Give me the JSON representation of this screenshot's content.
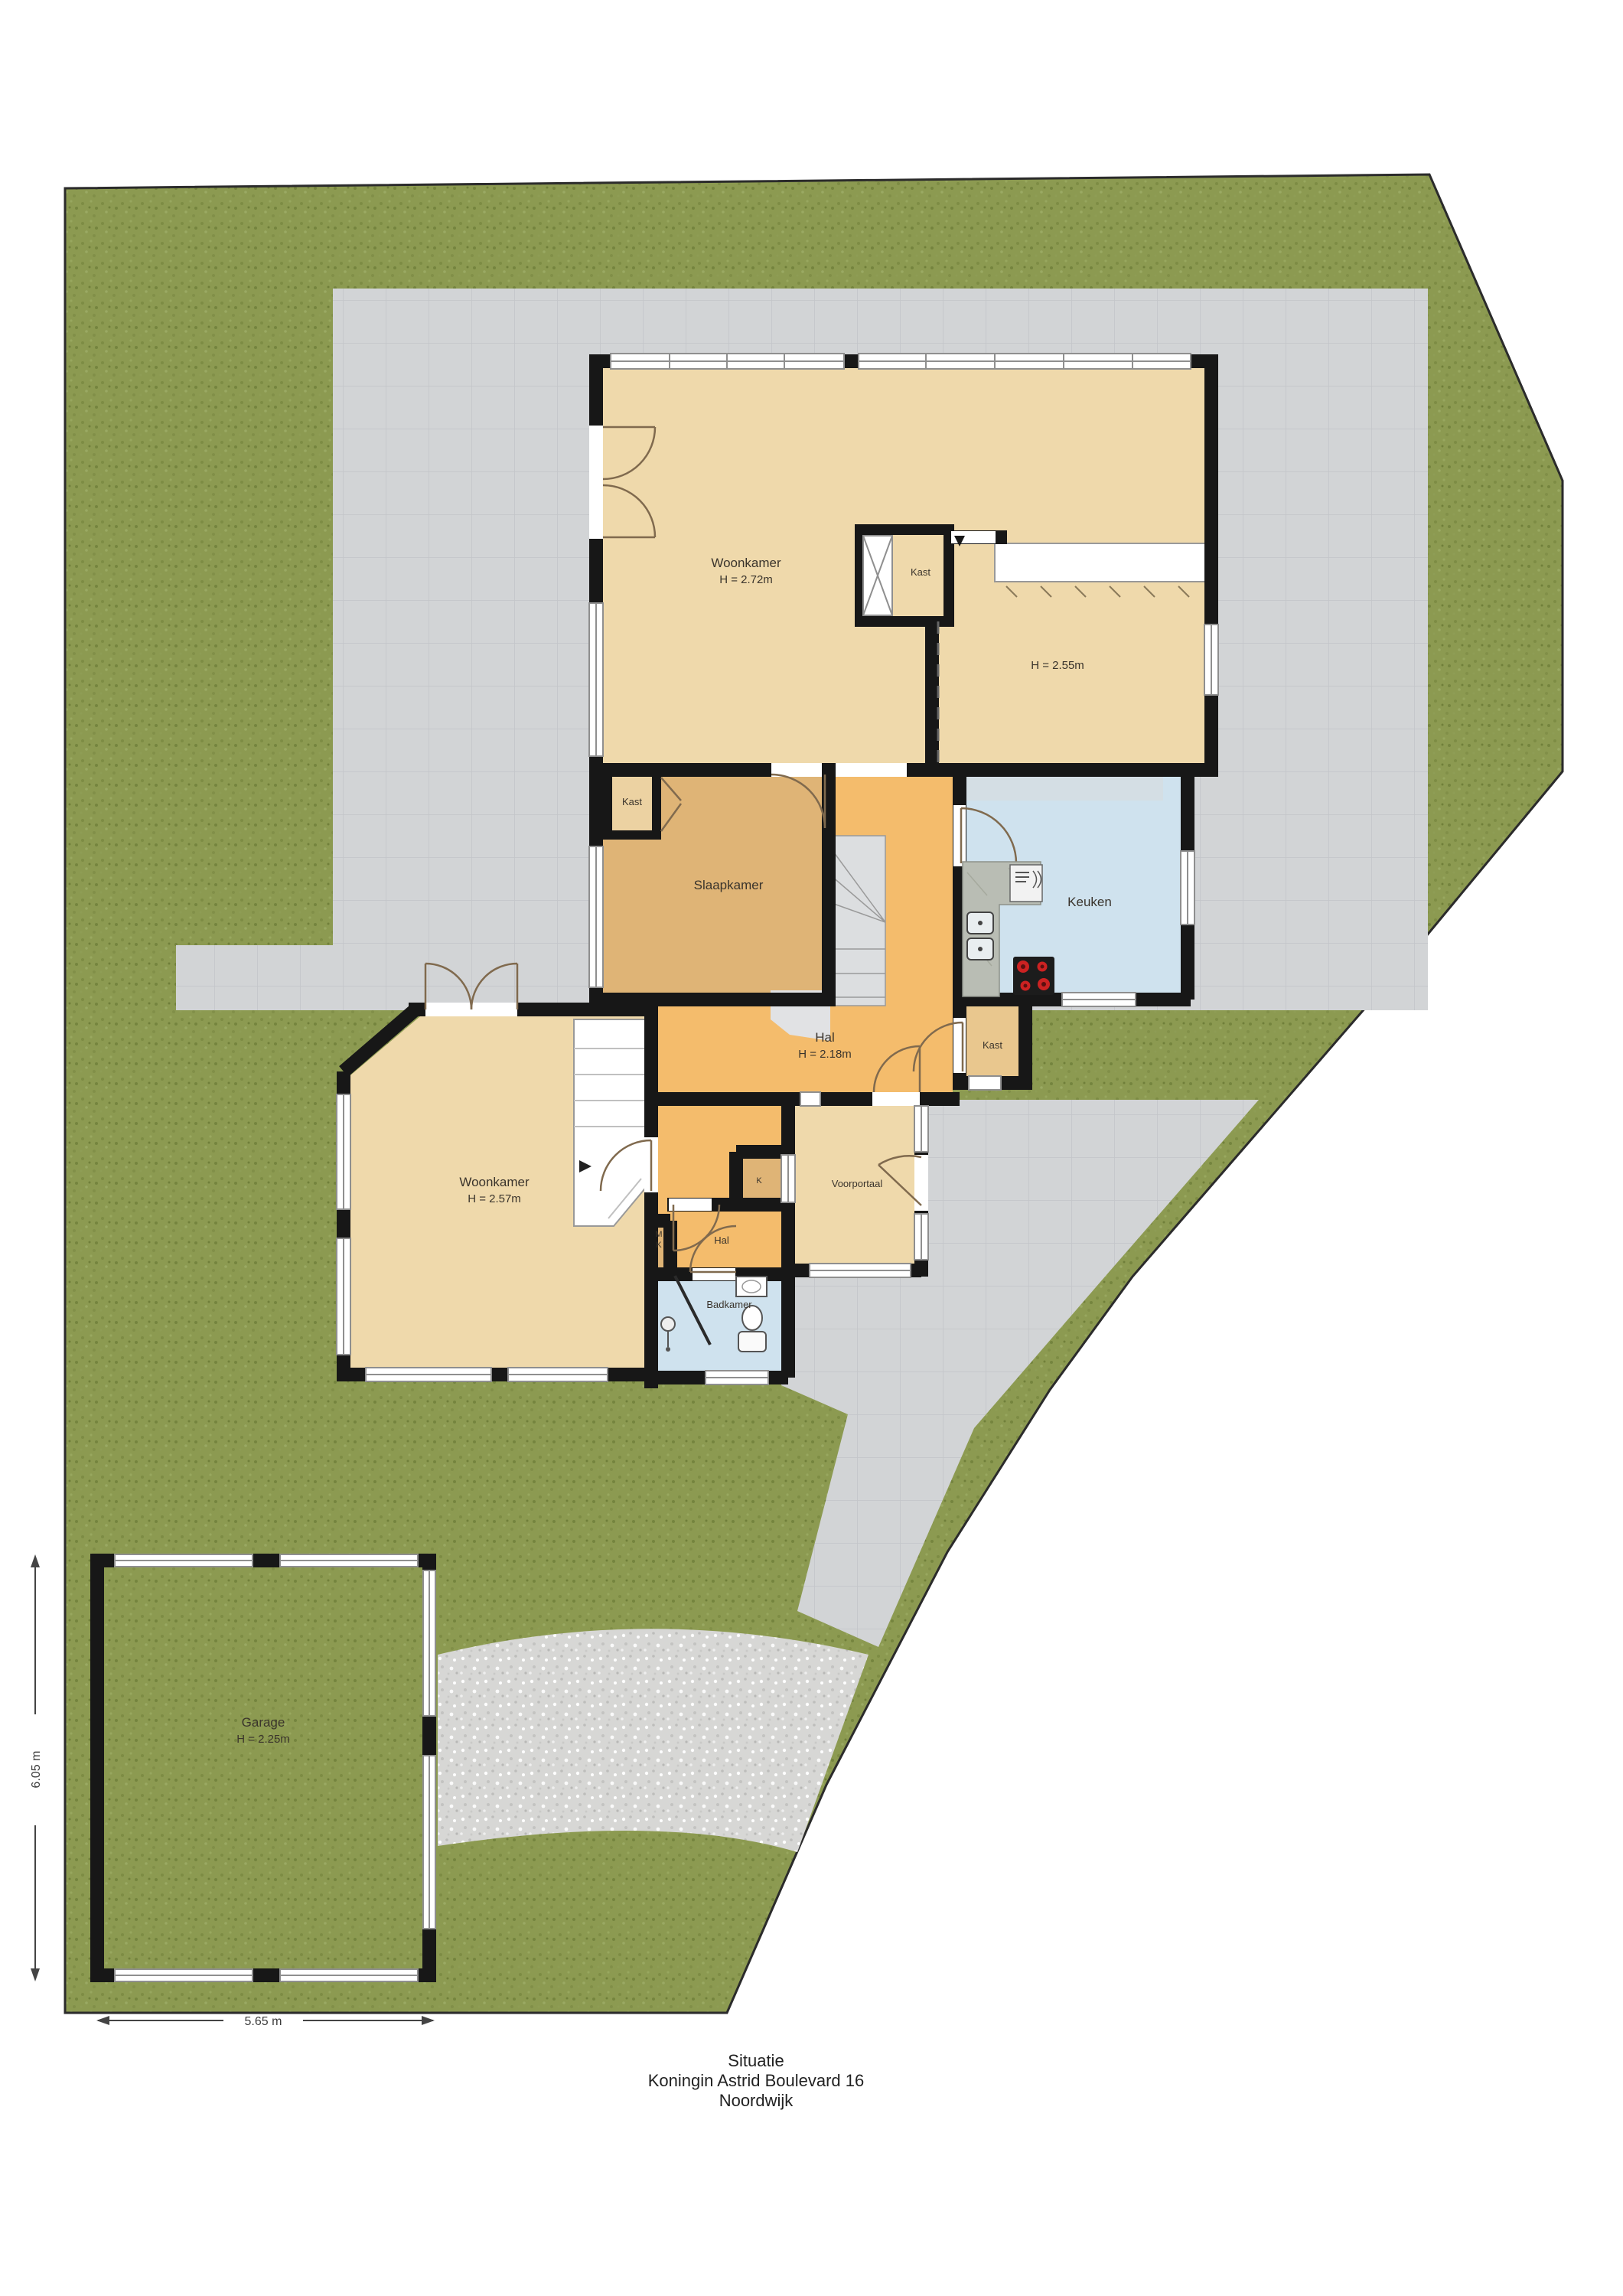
{
  "title": {
    "line1": "Situatie",
    "line2": "Koningin Astrid Boulevard 16",
    "line3": "Noordwijk"
  },
  "dimensions": {
    "garage_height": "6.05 m",
    "garage_width": "5.65 m"
  },
  "rooms": {
    "woonkamer_boven": {
      "name": "Woonkamer",
      "height": "H = 2.72m"
    },
    "kast_boven": {
      "name": "Kast"
    },
    "eetkeuken": {
      "height": "H = 2.55m"
    },
    "slaapkamer": {
      "name": "Slaapkamer"
    },
    "kast_slaapkamer": {
      "name": "Kast"
    },
    "keuken": {
      "name": "Keuken"
    },
    "hal": {
      "name": "Hal",
      "height": "H = 2.18m"
    },
    "kast_hal": {
      "name": "Kast"
    },
    "woonkamer_beneden": {
      "name": "Woonkamer",
      "height": "H = 2.57m"
    },
    "voorportaal": {
      "name": "Voorportaal"
    },
    "kast_k": {
      "name": "K"
    },
    "meterkast": {
      "line1": "M",
      "line2": "K"
    },
    "hal_beneden": {
      "name": "Hal"
    },
    "badkamer": {
      "name": "Badkamer"
    },
    "garage": {
      "name": "Garage",
      "height": "H = 2.25m"
    }
  },
  "colors": {
    "grass": "#8c9a51",
    "terrace": "#d2d4d6",
    "gravel": "#d7d7d5",
    "wall": "#171717",
    "room_beige": "#efd9ab",
    "room_tan": "#dfb476",
    "hal_orange": "#f4bc6c",
    "water_blue": "#cfe2ee",
    "garage_gray": "#c8c8c8",
    "kast_tan": "#e9c78e",
    "counter_gray": "#b9bdb4",
    "burner_red": "#cc2222"
  }
}
